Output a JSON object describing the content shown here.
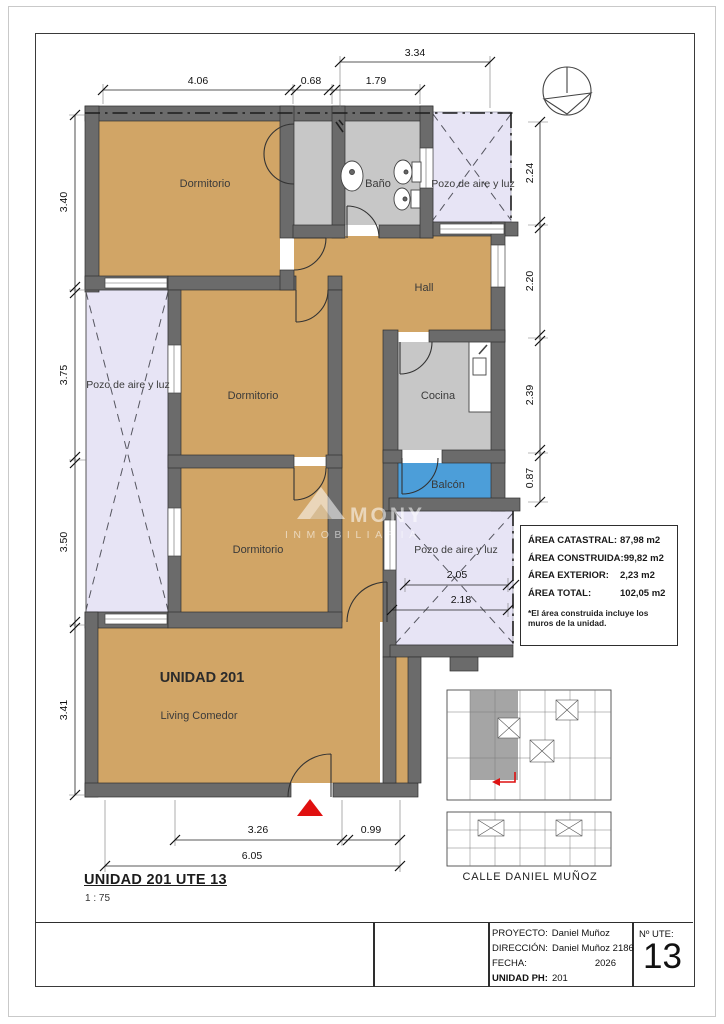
{
  "drawing": {
    "title": "UNIDAD 201 UTE 13",
    "scale": "1 : 75"
  },
  "rooms": {
    "dormitorio_1": "Dormitorio",
    "dormitorio_2": "Dormitorio",
    "dormitorio_3": "Dormitorio",
    "bano": "Baño",
    "hall": "Hall",
    "cocina": "Cocina",
    "balcon": "Balcón",
    "unidad": "UNIDAD 201",
    "living_comedor": "Living Comedor",
    "pozo_left": "Pozo de aire y luz",
    "pozo_top_right": "Pozo de aire y luz",
    "pozo_bottom_right": "Pozo de aire y luz"
  },
  "dims": {
    "top_total": "3.34",
    "top_a": "4.06",
    "top_b": "0.68",
    "top_c": "1.79",
    "left_a": "3.40",
    "left_b": "3.75",
    "left_c": "3.50",
    "left_d": "3.41",
    "right_a": "2.24",
    "right_b": "2.20",
    "right_c": "2.39",
    "right_d": "0.87",
    "pozo_a": "2.05",
    "pozo_b": "2.18",
    "bottom_a": "3.26",
    "bottom_b": "0.99",
    "bottom_total": "6.05"
  },
  "area_table": {
    "rows": [
      {
        "label": "ÁREA CATASTRAL:",
        "value": "87,98 m2"
      },
      {
        "label": "ÁREA CONSTRUIDA:",
        "value": "99,82 m2"
      },
      {
        "label": "ÁREA EXTERIOR:",
        "value": "2,23 m2"
      },
      {
        "label": "ÁREA TOTAL:",
        "value": "102,05 m2"
      }
    ],
    "note1": "*El área construida incluye los",
    "note2": "muros de la unidad."
  },
  "keyplan": {
    "street": "CALLE DANIEL MUÑOZ"
  },
  "watermark": {
    "name": "MONY",
    "tagline": "INMOBILIARIA"
  },
  "title_block": {
    "proyecto_label": "PROYECTO:",
    "proyecto_value": "Daniel Muñoz",
    "direccion_label": "DIRECCIÓN:",
    "direccion_value": "Daniel Muñoz 2186",
    "fecha_label": "FECHA:",
    "fecha_value": "2026",
    "unidad_label": "UNIDAD PH:",
    "unidad_value": "201",
    "ute_label": "Nº UTE:",
    "ute_value": "13"
  },
  "colors": {
    "room_fill": "#d1a566",
    "service_fill": "#c7c7c7",
    "pozo_fill": "#e7e4f5",
    "balcony_fill": "#4c9ed9",
    "wall_fill": "#6b6b6b",
    "entry_marker": "#e01010"
  }
}
